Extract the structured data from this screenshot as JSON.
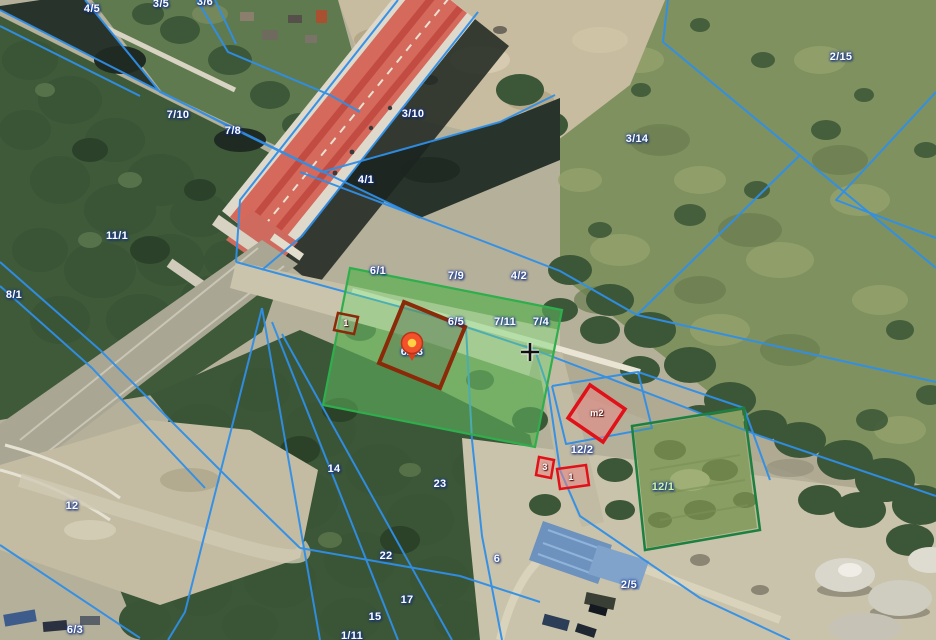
{
  "map": {
    "view": "aerial-cadastral",
    "colors": {
      "boundary_line": "#2f8fe8",
      "highlight_parcel_stroke": "#2fae4e",
      "highlight_parcel_fill": "rgba(110,215,110,0.42)",
      "building_outline_brown": "#8a2a08",
      "red_building_stroke": "#e01118",
      "parcel_12_1_stroke": "#1c8040",
      "label_text": "#ffffff",
      "label_halo": "#1d3f9e",
      "parcel_12_1_label_color": "#cdf6a3",
      "marker_body": "#f2512b",
      "marker_center": "#ffd044"
    },
    "parcel_labels": [
      {
        "text": "4/5",
        "x": 92,
        "y": 9
      },
      {
        "text": "3/5",
        "x": 161,
        "y": 4
      },
      {
        "text": "3/6",
        "x": 205,
        "y": 2
      },
      {
        "text": "7/10",
        "x": 178,
        "y": 115
      },
      {
        "text": "7/8",
        "x": 233,
        "y": 131
      },
      {
        "text": "3/10",
        "x": 413,
        "y": 114
      },
      {
        "text": "4/1",
        "x": 366,
        "y": 180
      },
      {
        "text": "11/1",
        "x": 117,
        "y": 236
      },
      {
        "text": "8/1",
        "x": 14,
        "y": 295
      },
      {
        "text": "2/15",
        "x": 841,
        "y": 57
      },
      {
        "text": "3/14",
        "x": 637,
        "y": 139
      },
      {
        "text": "6/1",
        "x": 378,
        "y": 271
      },
      {
        "text": "7/9",
        "x": 456,
        "y": 276
      },
      {
        "text": "4/2",
        "x": 519,
        "y": 276
      },
      {
        "text": "6/5",
        "x": 456,
        "y": 322
      },
      {
        "text": "7/11",
        "x": 505,
        "y": 322
      },
      {
        "text": "7/4",
        "x": 541,
        "y": 322
      },
      {
        "text": "6/13",
        "x": 412,
        "y": 352
      },
      {
        "text": "12/2",
        "x": 582,
        "y": 450
      },
      {
        "text": "12/1",
        "x": 663,
        "y": 487,
        "color": "#cdf6a3"
      },
      {
        "text": "14",
        "x": 334,
        "y": 469
      },
      {
        "text": "23",
        "x": 440,
        "y": 484
      },
      {
        "text": "22",
        "x": 386,
        "y": 556
      },
      {
        "text": "6",
        "x": 497,
        "y": 559
      },
      {
        "text": "17",
        "x": 407,
        "y": 600
      },
      {
        "text": "15",
        "x": 375,
        "y": 617
      },
      {
        "text": "1/11",
        "x": 352,
        "y": 636
      },
      {
        "text": "12",
        "x": 72,
        "y": 506
      },
      {
        "text": "6/3",
        "x": 75,
        "y": 630
      },
      {
        "text": "2/5",
        "x": 629,
        "y": 585
      }
    ],
    "building_labels": [
      {
        "text": "1",
        "x": 346,
        "y": 323
      },
      {
        "text": "m2",
        "x": 597,
        "y": 413
      },
      {
        "text": "3",
        "x": 545,
        "y": 467
      },
      {
        "text": "1",
        "x": 571,
        "y": 477
      }
    ],
    "marker": {
      "x": 412,
      "y": 343,
      "label_behind": "6/13"
    },
    "crosshair": {
      "x": 530,
      "y": 352
    }
  }
}
